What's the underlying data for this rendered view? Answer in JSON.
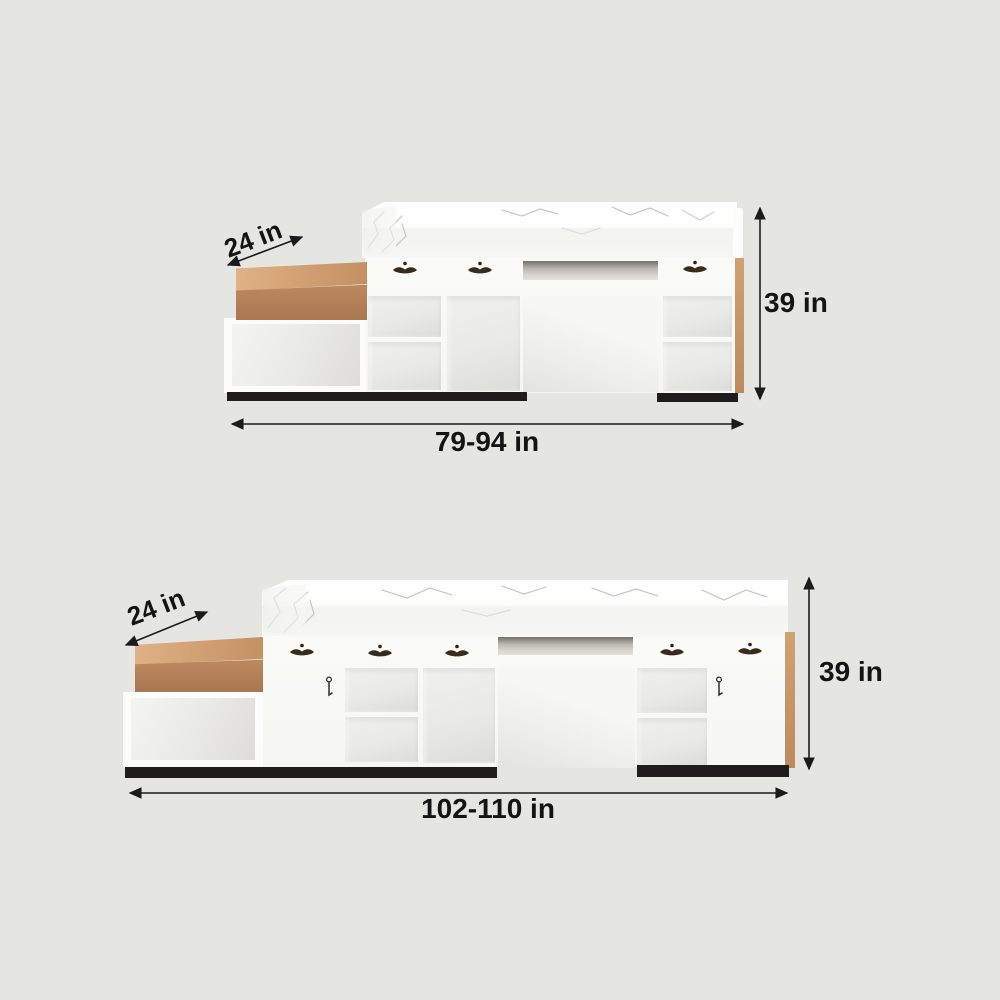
{
  "colors": {
    "background": "#e5e6e1",
    "wood": "#b5825a",
    "marble": "#fafaf8",
    "kick_base": "#1e1d1b",
    "dimension_text": "#141414"
  },
  "figures": [
    {
      "depth_label": "24 in",
      "height_label": "39 in",
      "width_label": "79-94 in"
    },
    {
      "depth_label": "24 in",
      "height_label": "39 in",
      "width_label": "102-110 in"
    }
  ]
}
